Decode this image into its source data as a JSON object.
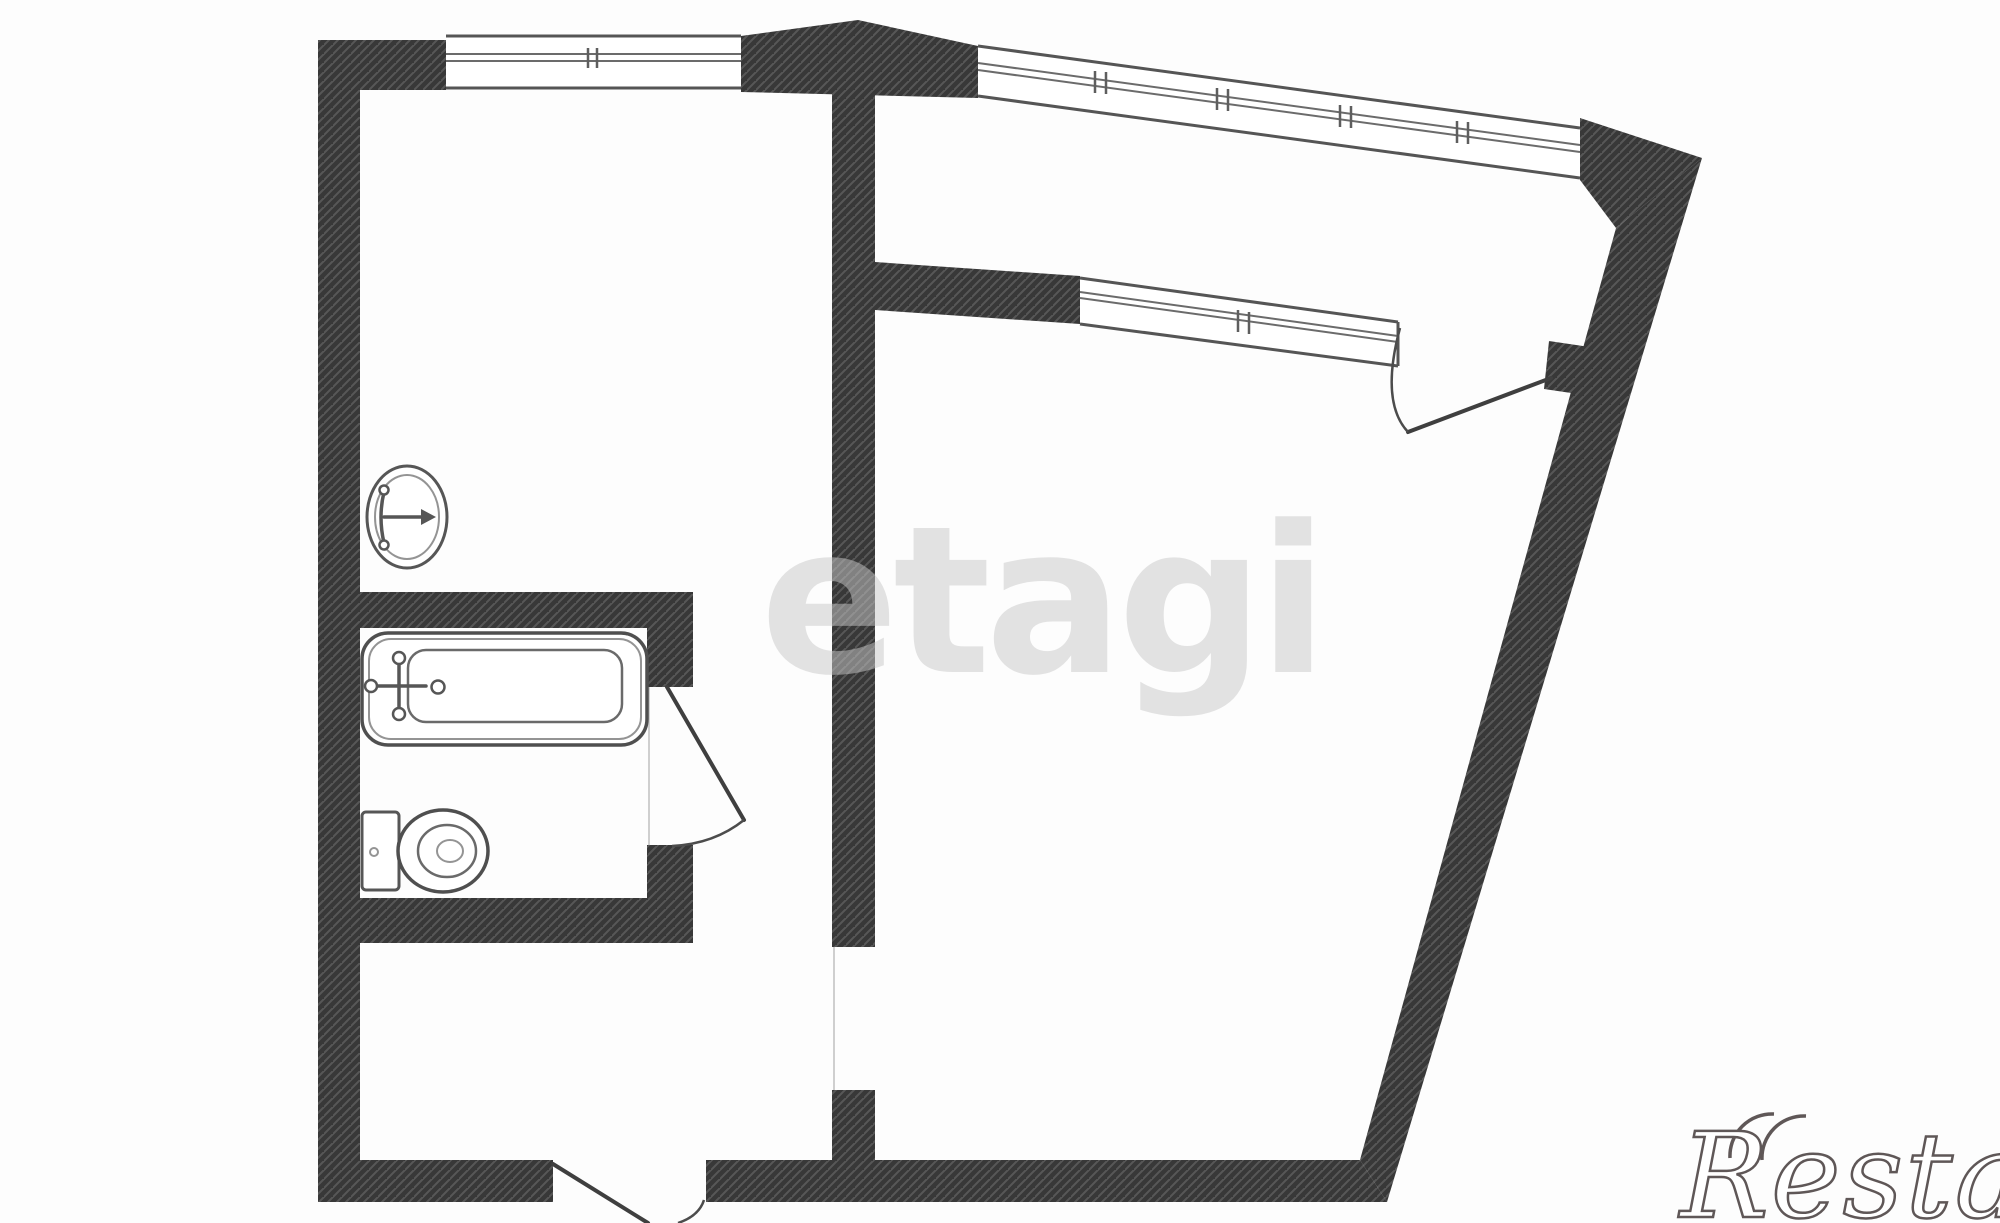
{
  "meta": {
    "type": "apartment-floor-plan",
    "description": "Black-and-white architectural floor plan of a one-room apartment with hatched walls, a bathroom with bathtub and toilet, a sink room, a hallway, a large trapezoidal living room and a glazed balcony strip along the slanted top-right walls"
  },
  "colors": {
    "background": "#fdfdfd",
    "wall_fill": "#383838",
    "wall_hatch": "#575757",
    "line": "#555555",
    "watermark_center_fill": "#c9c9c9",
    "logo_fill": "#ffffff",
    "logo_stroke": "#5f5757"
  },
  "watermarks": {
    "center_text": "etagi",
    "logo_text": "Restate"
  },
  "inventory": {
    "rooms": [
      {
        "name": "top-left-room"
      },
      {
        "name": "bathroom"
      },
      {
        "name": "hallway"
      },
      {
        "name": "living-room"
      },
      {
        "name": "balcony"
      }
    ],
    "fixtures": [
      {
        "name": "sink",
        "icon": "oval-basin-with-tap-arrow"
      },
      {
        "name": "bathtub",
        "icon": "rounded-tub-with-faucet-cross"
      },
      {
        "name": "toilet",
        "icon": "tank-and-oval-bowl"
      }
    ],
    "windows": [
      {
        "name": "left-room-window",
        "ticks": 1
      },
      {
        "name": "balcony-outer-window",
        "ticks": 4
      },
      {
        "name": "balcony-inner-window",
        "ticks": 1
      }
    ],
    "doors": [
      {
        "name": "bathroom-door",
        "swing": "open-right"
      },
      {
        "name": "balcony-door",
        "swing": "open-into-balcony"
      },
      {
        "name": "entrance-door",
        "swing": "open-outward-bottom"
      },
      {
        "name": "interior-doorway",
        "swing": "none"
      }
    ]
  }
}
